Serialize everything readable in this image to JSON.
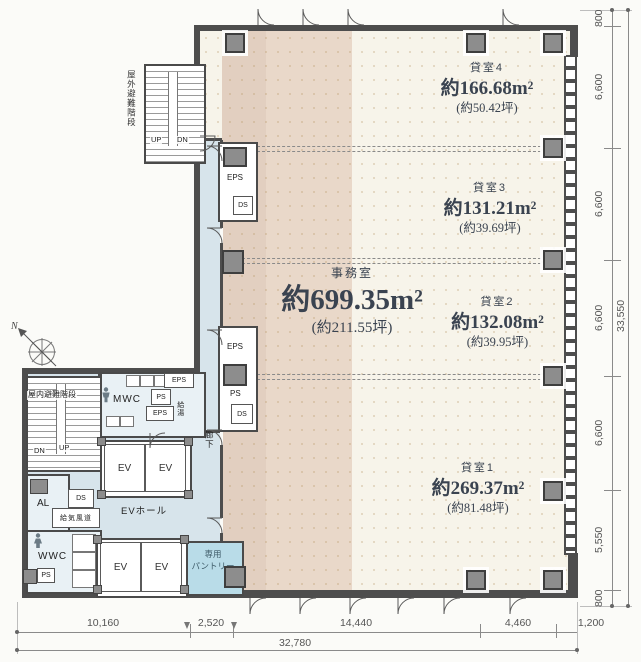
{
  "plan": {
    "rooms": {
      "office": {
        "name": "事務室",
        "area": "約699.35m²",
        "tsubo": "(約211.55坪)"
      },
      "unit4": {
        "name": "貸室4",
        "area": "約166.68m²",
        "tsubo": "(約50.42坪)"
      },
      "unit3": {
        "name": "貸室3",
        "area": "約131.21m²",
        "tsubo": "(約39.69坪)"
      },
      "unit2": {
        "name": "貸室2",
        "area": "約132.08m²",
        "tsubo": "(約39.95坪)"
      },
      "unit1": {
        "name": "貸室1",
        "area": "約269.37m²",
        "tsubo": "(約81.48坪)"
      }
    },
    "labels": {
      "outdoor_stairs": "屋外避難階段",
      "indoor_stairs": "屋内避難階段",
      "mwc": "MWC",
      "wwc": "WWC",
      "ev": "EV",
      "ev_hall": "EVホール",
      "pantry_line1": "専用",
      "pantry_line2": "パントリー",
      "supply_duct": "給気風道",
      "hot_water": "給湯",
      "corridor": "廊下",
      "al": "AL",
      "up": "UP",
      "dn": "DN",
      "eps": "EPS",
      "ps": "PS",
      "ds": "DS"
    },
    "compass": {
      "north": "N"
    }
  },
  "dimensions": {
    "right": [
      "800",
      "6,600",
      "6,600",
      "6,600",
      "6,600",
      "5,550",
      "800"
    ],
    "right_total": "33,550",
    "bottom": [
      "10,160",
      "2,520",
      "14,440",
      "4,460",
      "1,200"
    ],
    "bottom_total": "32,780"
  },
  "colors": {
    "wall": "#4d4d4d",
    "tan_band": "#e5d2c2",
    "common_area": "#d7e4eb",
    "pantry": "#b9dce8",
    "floor": "#f7f4ea"
  }
}
